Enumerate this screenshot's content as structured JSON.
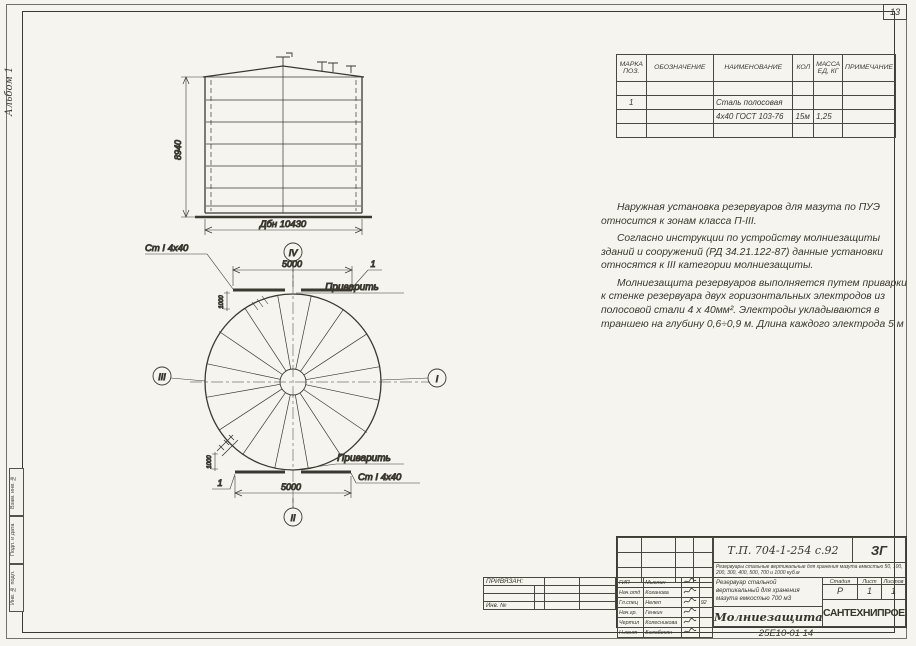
{
  "sheet": {
    "corner_number": "13",
    "album_label": "Альбом 1",
    "doc_number": "25Е10-01   14",
    "margin_stamp": [
      "Взам. инв. №",
      "Подп. и дата",
      "Инв. № подл."
    ]
  },
  "parts_table": {
    "headers": [
      "Марка поз.",
      "Обозначение",
      "Наименование",
      "Кол",
      "Масса ед, кг",
      "Примечание"
    ],
    "rows": [
      [
        "",
        "",
        "",
        "",
        "",
        ""
      ],
      [
        "1",
        "",
        "Сталь полосовая",
        "",
        "",
        ""
      ],
      [
        "",
        "",
        "4х40 ГОСТ 103-76",
        "15м",
        "1,25",
        ""
      ],
      [
        "",
        "",
        "",
        "",
        "",
        ""
      ]
    ]
  },
  "notes": {
    "p1": "Наружная установка резервуаров для мазута по ПУЭ относится к зонам класса П-III.",
    "p2": "Согласно инструкции по устройству молниезащиты зданий и сооружений (РД 34.21.122-87) данные установки относятся к III категории молниезащиты.",
    "p3": "Молниезащита резервуаров выполняется путем приварки к стенке резервуара двух горизонтальных электродов из полосовой стали 4 х 40мм². Электроды укладываются в траншею на глубину 0,6÷0,9 м. Длина каждого электрода 5 м"
  },
  "drawing": {
    "elevation": {
      "height_dim": "8940",
      "diameter_dim": "Дбн 10430"
    },
    "plan": {
      "balloon_top": "IV",
      "balloon_bottom": "II",
      "balloon_left": "III",
      "balloon_right": "I",
      "dim_top": "5000",
      "dim_bottom": "5000",
      "offset_top": "1000",
      "offset_bottom": "1000",
      "weld_top": "Приварить",
      "weld_bottom": "Приварить",
      "steel_top": "Ст I 4х40",
      "steel_bottom": "Ст I 4х40",
      "item_top": "1",
      "item_bottom": "1"
    }
  },
  "title_block": {
    "doc_code": "Т.П. 704-1-254 с.92",
    "doc_suffix": "ЗГ",
    "series_note": "Резервуары стальные вертикальные для хранения мазута емкостью 50, 100, 200, 300, 400, 500, 700 и 1000 куб.м",
    "object_title": "Резервуар стальной вертикальный для хранения мазута емкостью 700 м3",
    "sheet_title": "Молниезащита",
    "organization": "САНТЕХНИПРОЕКТ",
    "stage_label": "Стадия",
    "stage": "Р",
    "sheet_label": "Лист",
    "sheet_no": "1",
    "sheets_label": "Листов",
    "sheets_total": "1",
    "roles": [
      {
        "role": "ГИП",
        "name": "Мыслин"
      },
      {
        "role": "Нач.отд",
        "name": "Коганова"
      },
      {
        "role": "Гл.спец",
        "name": "Нелеп",
        "date": "92"
      },
      {
        "role": "Нач.гр.",
        "name": "Генкин"
      },
      {
        "role": "Чертил",
        "name": "Колесникова"
      },
      {
        "role": "Н.конт",
        "name": "Балабекян"
      }
    ],
    "linked_label": "ПРИВЯЗАН:",
    "inv_label": "Инв. №"
  }
}
